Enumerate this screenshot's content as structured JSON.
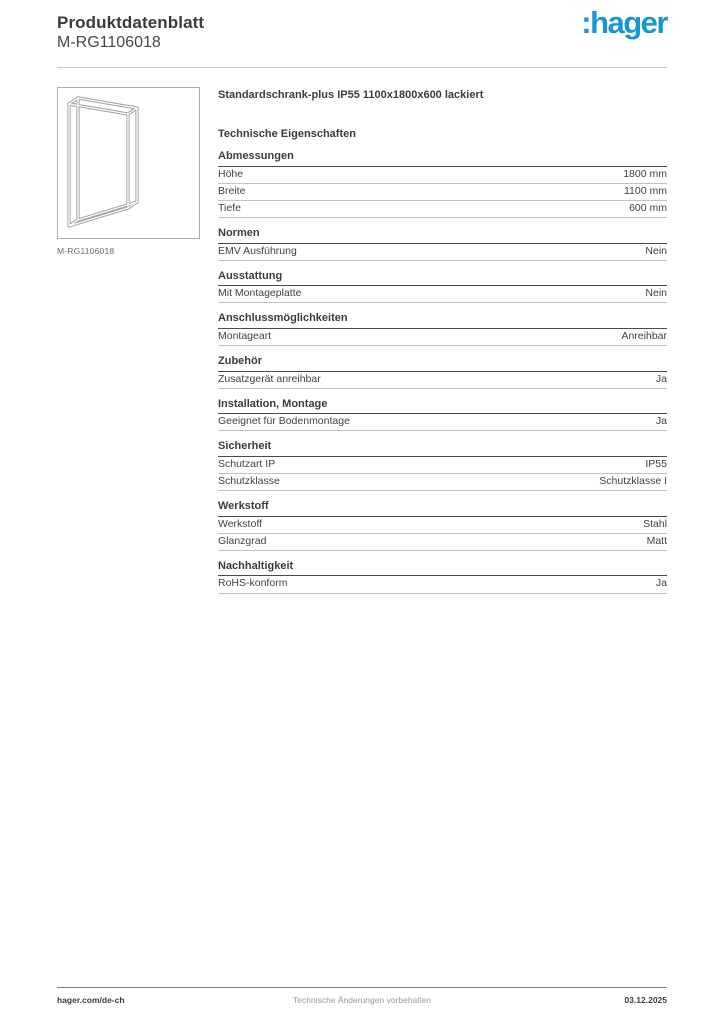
{
  "header": {
    "title": "Produktdatenblatt",
    "product_code": "M-RG1106018",
    "logo_text": ":hager",
    "logo_color": "#1896d4"
  },
  "product": {
    "image_caption": "M-RG1106018",
    "title": "Standardschrank-plus IP55 1100x1800x600 lackiert",
    "section_title": "Technische Eigenschaften"
  },
  "sections": [
    {
      "heading": "Abmessungen",
      "rows": [
        {
          "label": "Höhe",
          "value": "1800 mm"
        },
        {
          "label": "Breite",
          "value": "1100 mm"
        },
        {
          "label": "Tiefe",
          "value": "600 mm"
        }
      ]
    },
    {
      "heading": "Normen",
      "rows": [
        {
          "label": "EMV Ausführung",
          "value": "Nein"
        }
      ]
    },
    {
      "heading": "Ausstattung",
      "rows": [
        {
          "label": "Mit Montageplatte",
          "value": "Nein"
        }
      ]
    },
    {
      "heading": "Anschlussmöglichkeiten",
      "rows": [
        {
          "label": "Montageart",
          "value": "Anreihbar"
        }
      ]
    },
    {
      "heading": "Zubehör",
      "rows": [
        {
          "label": "Zusatzgerät anreihbar",
          "value": "Ja"
        }
      ]
    },
    {
      "heading": "Installation, Montage",
      "rows": [
        {
          "label": "Geeignet für Bodenmontage",
          "value": "Ja"
        }
      ]
    },
    {
      "heading": "Sicherheit",
      "rows": [
        {
          "label": "Schutzart IP",
          "value": "IP55"
        },
        {
          "label": "Schutzklasse",
          "value": "Schutzklasse I"
        }
      ]
    },
    {
      "heading": "Werkstoff",
      "rows": [
        {
          "label": "Werkstoff",
          "value": "Stahl"
        },
        {
          "label": "Glanzgrad",
          "value": "Matt"
        }
      ]
    },
    {
      "heading": "Nachhaltigkeit",
      "rows": [
        {
          "label": "RoHS-konform",
          "value": "Ja"
        }
      ]
    }
  ],
  "footer": {
    "left": "hager.com/de-ch",
    "center": "Technische Änderungen vorbehalten",
    "right": "03.12.2025"
  }
}
